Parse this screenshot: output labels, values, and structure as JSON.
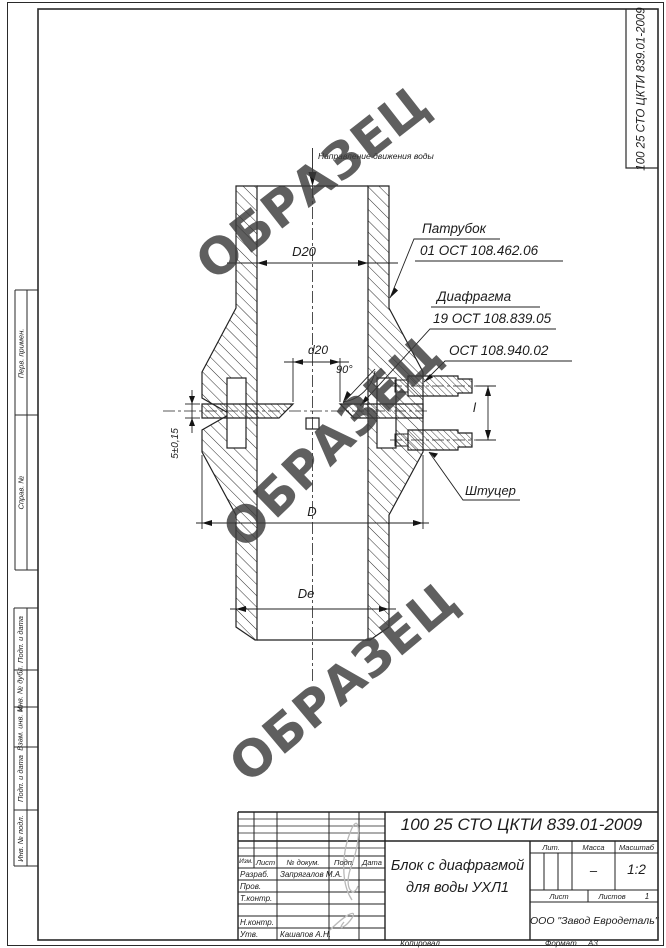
{
  "watermark": {
    "text": "ОБРАЗЕЦ"
  },
  "corner_stamp": {
    "doc_number": "100 25 СТО ЦКТИ 839.01-2009"
  },
  "side_stamps": {
    "perv_primen": "Перв. примен.",
    "sprav_no": "Справ. №",
    "podp_data_1": "Подп. и дата",
    "inv_dubl": "Инв. № дубл.",
    "vzam_inv": "Взам. инв. №",
    "podp_data_2": "Подп. и дата",
    "inv_podl": "Инв. № подл."
  },
  "drawing": {
    "flow_direction": "Направление движения воды",
    "dim_top_bore": "D20",
    "dim_orifice": "d20",
    "dim_angle": "90°",
    "dim_thickness": "5±0,15",
    "dim_outer": "D",
    "dim_bottom": "Dе",
    "dim_fitting_length": "l",
    "callout_patrubok_title": "Патрубок",
    "callout_patrubok_std": "01 ОСТ 108.462.06",
    "callout_diafragma_title": "Диафрагма",
    "callout_diafragma_std": "19 ОСТ 108.839.05",
    "callout_ost_std": "ОСТ 108.940.02",
    "callout_shtutser": "Штуцер"
  },
  "title_block": {
    "doc_number": "100 25 СТО ЦКТИ 839.01-2009",
    "title_line1": "Блок с диафрагмой",
    "title_line2": "для воды УХЛ1",
    "company": "ООО \"Завод Евродеталь\"",
    "col_izm": "Изм.",
    "col_list": "Лист",
    "col_ndokum": "№ докум.",
    "col_podp": "Подп.",
    "col_data": "Дата",
    "row_razrab": "Разраб.",
    "row_razrab_name": "Запрягалов М.А.",
    "row_prov": "Пров.",
    "row_tkontr": "Т.контр.",
    "row_nkontr": "Н.контр.",
    "row_utv": "Утв.",
    "row_utv_name": "Кашапов А.Н.",
    "lit_label": "Лит.",
    "mass_label": "Масса",
    "mass_value": "–",
    "scale_label": "Масштаб",
    "scale_value": "1:2",
    "list_label": "Лист",
    "listov_label": "Листов",
    "listov_value": "1",
    "kopiroval": "Копировал",
    "format_label": "Формат",
    "format_value": "А3"
  }
}
